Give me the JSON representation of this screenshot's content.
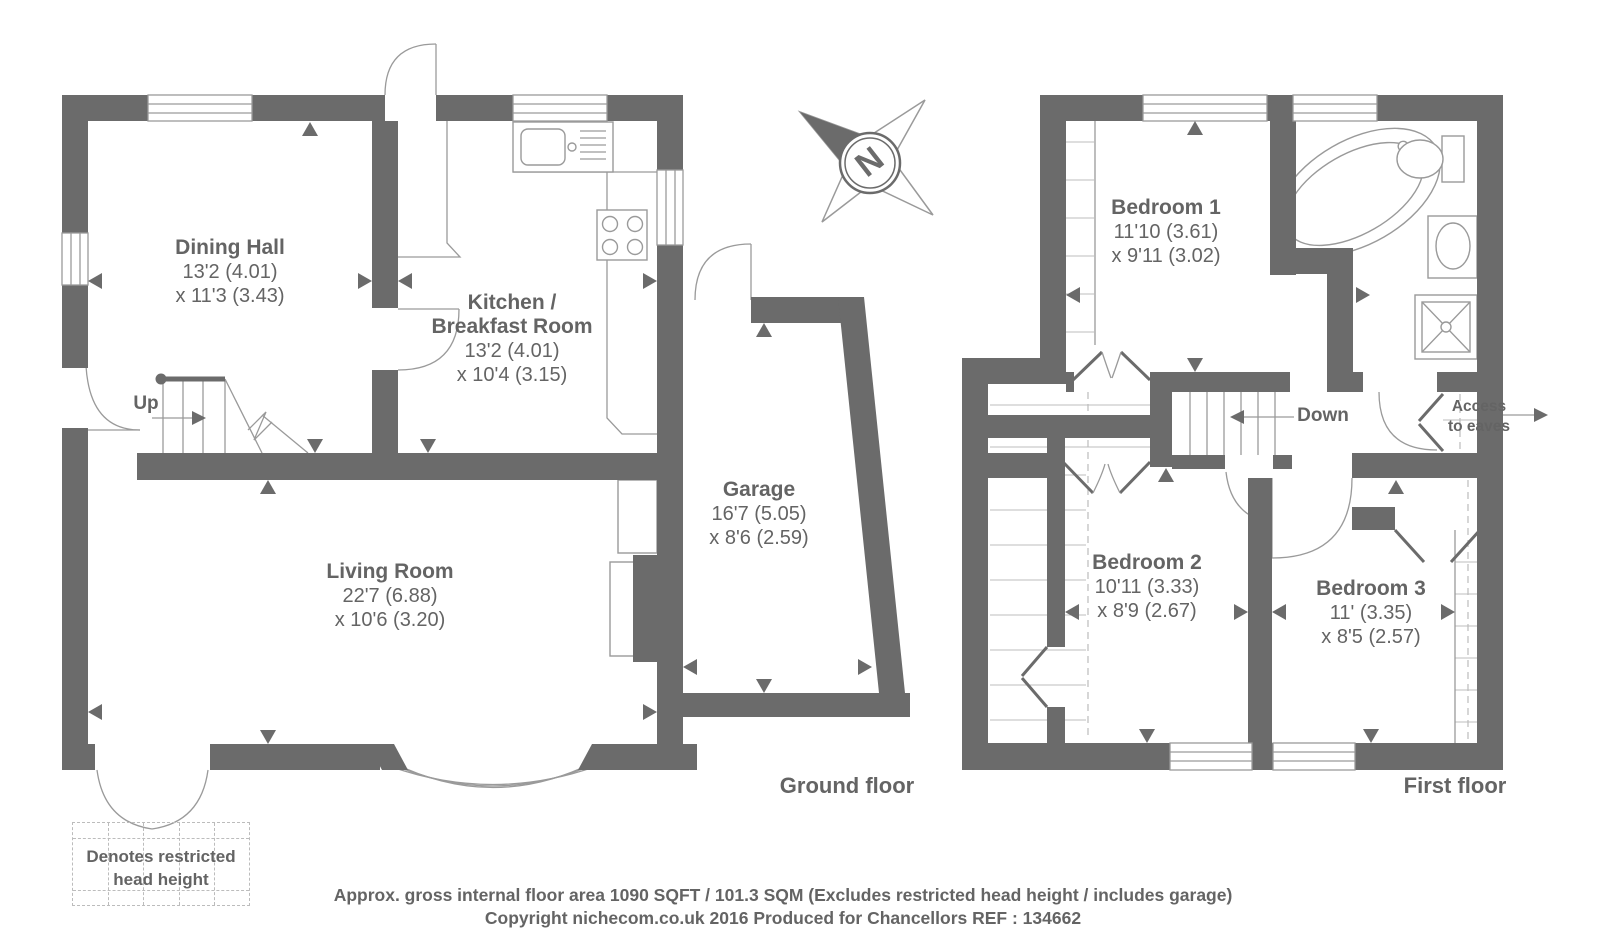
{
  "ground_floor": {
    "label": "Ground floor",
    "up_label": "Up",
    "rooms": {
      "dining": {
        "line1": "Dining Hall",
        "line2": "13'2 (4.01)",
        "line3": "x 11'3 (3.43)"
      },
      "kitchen": {
        "line1": "Kitchen /",
        "line2": "Breakfast Room",
        "line3": "13'2 (4.01)",
        "line4": "x 10'4 (3.15)"
      },
      "living": {
        "line1": "Living Room",
        "line2": "22'7 (6.88)",
        "line3": "x 10'6 (3.20)"
      },
      "garage": {
        "line1": "Garage",
        "line2": "16'7 (5.05)",
        "line3": "x 8'6 (2.59)"
      }
    }
  },
  "first_floor": {
    "label": "First floor",
    "down_label": "Down",
    "eaves_access": {
      "line1": "Access",
      "line2": "to eaves"
    },
    "rooms": {
      "bedroom1": {
        "line1": "Bedroom 1",
        "line2": "11'10 (3.61)",
        "line3": "x 9'11 (3.02)"
      },
      "bedroom2": {
        "line1": "Bedroom 2",
        "line2": "10'11 (3.33)",
        "line3": "x 8'9 (2.67)"
      },
      "bedroom3": {
        "line1": "Bedroom 3",
        "line2": "11' (3.35)",
        "line3": "x 8'5 (2.57)"
      }
    }
  },
  "compass": {
    "north_label": "N"
  },
  "legend": {
    "line1": "Denotes restricted",
    "line2": "head height"
  },
  "footer": {
    "line1": "Approx. gross internal floor area 1090 SQFT / 101.3 SQM (Excludes restricted head height / includes garage)",
    "line2": "Copyright nichecom.co.uk 2016 Produced for Chancellors REF : 134662"
  },
  "colors": {
    "wall": "#6b6b6b",
    "text": "#646464",
    "thin_line": "#9a9a9a",
    "dash_line": "#bcbcbc"
  }
}
